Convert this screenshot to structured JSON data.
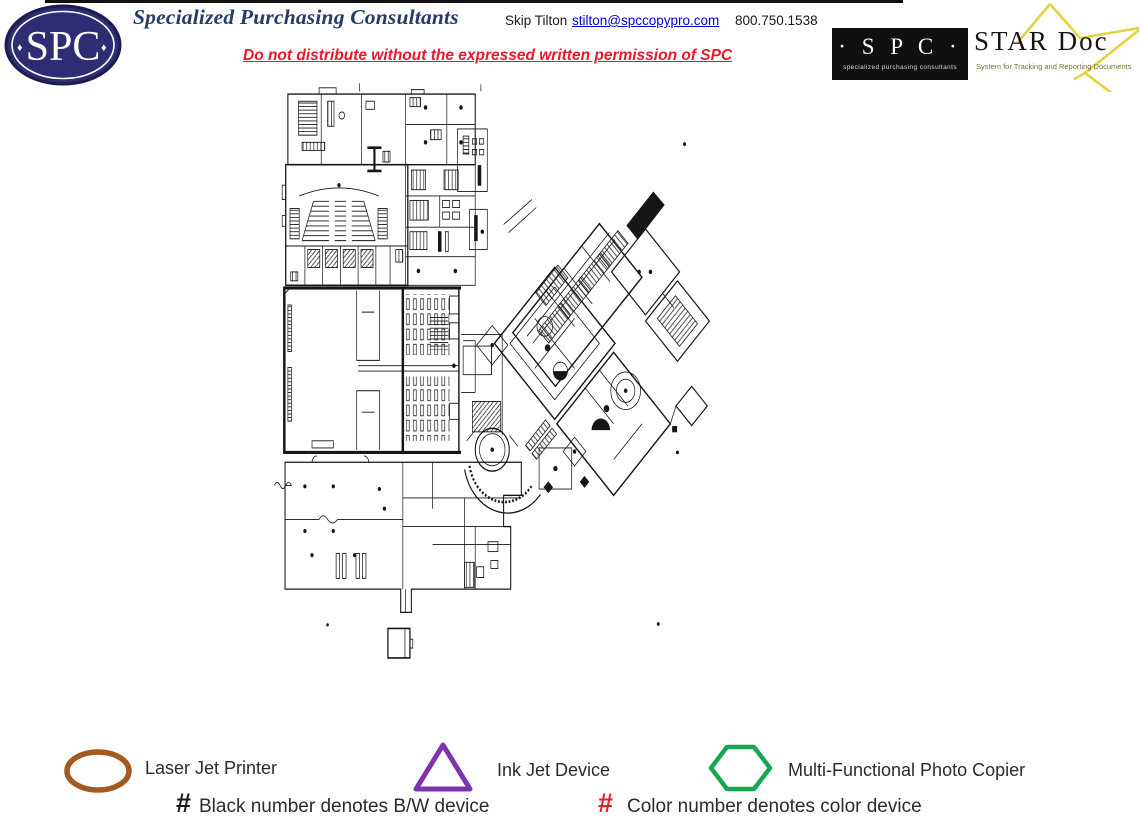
{
  "header": {
    "logo": {
      "text": "SPC",
      "diamond": "♦",
      "bg": "#2e2c72",
      "ring": "#ffffff"
    },
    "title": "Specialized Purchasing Consultants",
    "title_color": "#253a6d",
    "contact_name": "Skip Tilton",
    "contact_email": "stilton@spccopypro.com",
    "link_color": "#0000d8",
    "contact_phone": "800.750.1538",
    "warning": "Do not distribute without the expressed written permission of SPC",
    "warning_color": "#e8192c"
  },
  "star_doc_logo": {
    "spc_label": "· S P C ·",
    "spc_sublabel": "specialized purchasing consultants",
    "name": "STAR Doc",
    "tagline": "System for Tracking and Reporting Documents",
    "star_color": "#e6d23c",
    "box_bg": "#101010"
  },
  "floor_plan": {
    "description": "Scanned school campus floor plan with auditorium, gymnasium, cafeteria, rotunda, two diagonal classroom wings and shop building",
    "ink": "#161616"
  },
  "legend": {
    "devices": [
      {
        "shape": "oval",
        "color": "#a3591f",
        "label": "Laser Jet Printer"
      },
      {
        "shape": "triangle",
        "color": "#7d35ae",
        "label": "Ink Jet Device"
      },
      {
        "shape": "hexagon",
        "color": "#17a750",
        "label": "Multi-Functional Photo Copier"
      }
    ],
    "notes": [
      {
        "symbol": "#",
        "symbol_color": "#1a1a1a",
        "text": "Black number denotes B/W device"
      },
      {
        "symbol": "#",
        "symbol_color": "#ed1c24",
        "text": "Color number denotes color device"
      }
    ]
  }
}
